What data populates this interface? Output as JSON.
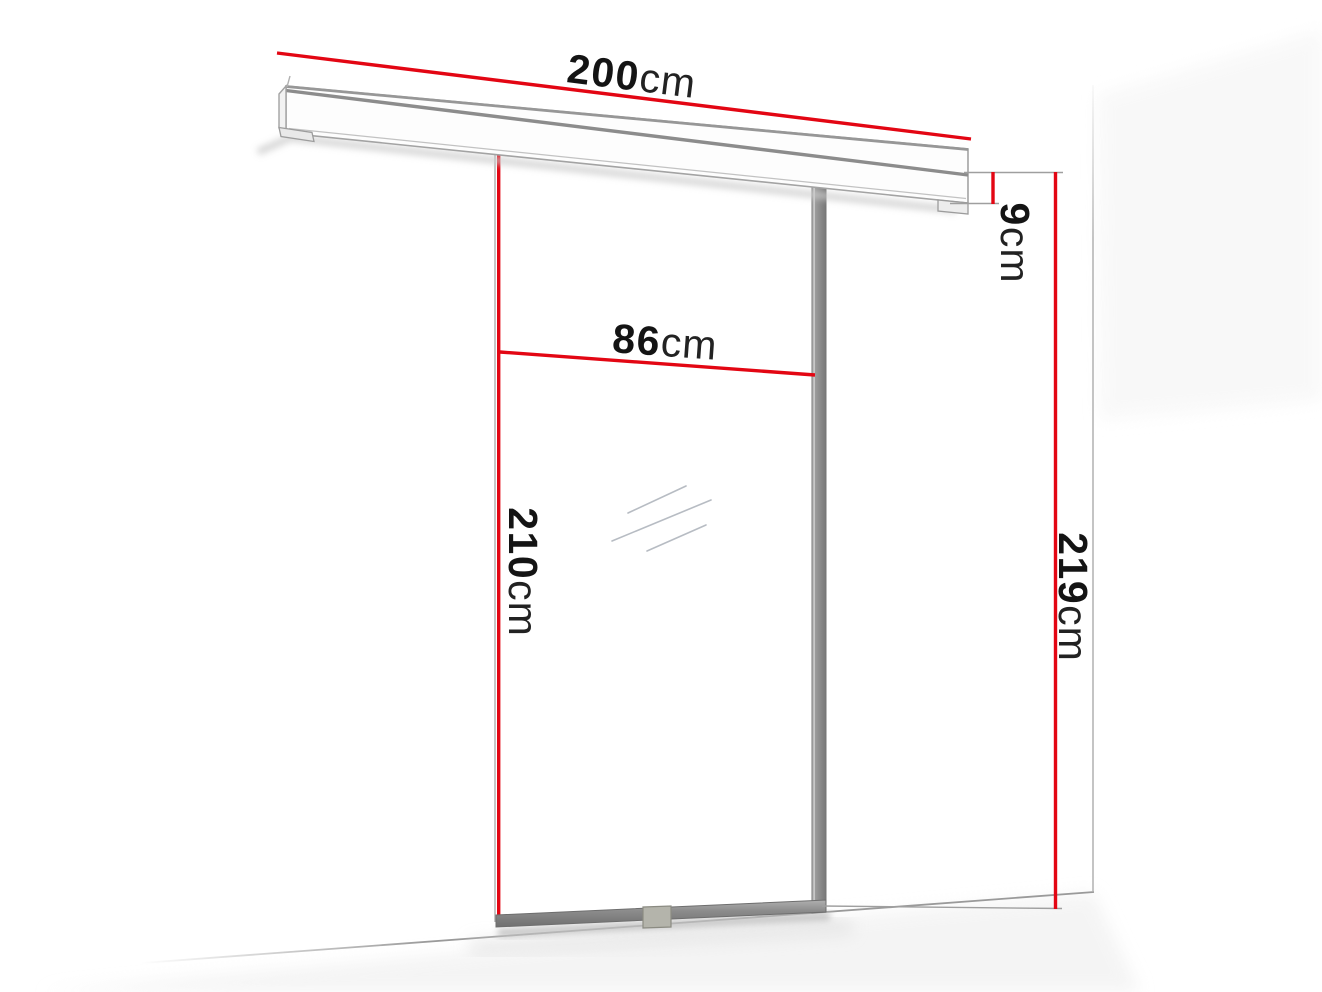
{
  "diagram": {
    "type": "sliding-door dimension drawing",
    "dimensions": {
      "rail_length": {
        "value": "200",
        "unit": "cm"
      },
      "door_width": {
        "value": "86",
        "unit": "cm"
      },
      "door_height": {
        "value": "210",
        "unit": "cm"
      },
      "rail_height": {
        "value": "9",
        "unit": "cm"
      },
      "total_height": {
        "value": "219",
        "unit": "cm"
      }
    },
    "colors": {
      "dimension_line": "#e30613",
      "frame_gray": "#8c8c8c",
      "outline_gray": "#a3a3a3",
      "extension_gray": "#9f9f9f",
      "text_black": "#141414"
    }
  }
}
